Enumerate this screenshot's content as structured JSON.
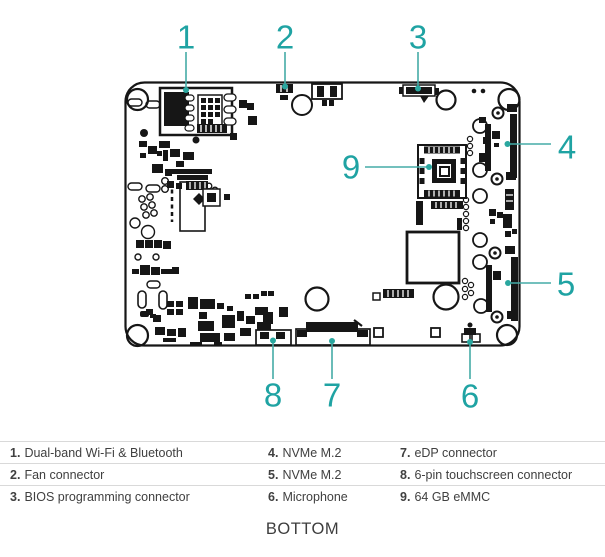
{
  "diagram": {
    "callouts": [
      {
        "number": "1",
        "label": "Dual-band Wi-Fi & Bluetooth"
      },
      {
        "number": "2",
        "label": "Fan connector"
      },
      {
        "number": "3",
        "label": "BIOS programming connector"
      },
      {
        "number": "4",
        "label": "NVMe M.2"
      },
      {
        "number": "5",
        "label": "NVMe M.2"
      },
      {
        "number": "6",
        "label": "Microphone"
      },
      {
        "number": "7",
        "label": "eDP connector"
      },
      {
        "number": "8",
        "label": "6-pin touchscreen connector"
      },
      {
        "number": "9",
        "label": "64 GB eMMC"
      }
    ],
    "view_label": "BOTTOM"
  },
  "legend": {
    "items": [
      {
        "num": "1.",
        "label": "Dual-band Wi-Fi & Bluetooth"
      },
      {
        "num": "2.",
        "label": "Fan connector"
      },
      {
        "num": "3.",
        "label": "BIOS programming connector"
      },
      {
        "num": "4.",
        "label": "NVMe M.2"
      },
      {
        "num": "5.",
        "label": "NVMe M.2"
      },
      {
        "num": "6.",
        "label": "Microphone"
      },
      {
        "num": "7.",
        "label": "eDP connector"
      },
      {
        "num": "8.",
        "label": "6-pin touchscreen connector"
      },
      {
        "num": "9.",
        "label": "64 GB eMMC"
      }
    ]
  },
  "colors": {
    "callout_teal": "#1fa3a3",
    "leader_line": "#45aca7",
    "line_art": "#161616",
    "legend_text": "#404040",
    "divider": "#d9d9d9",
    "background": "#ffffff"
  }
}
